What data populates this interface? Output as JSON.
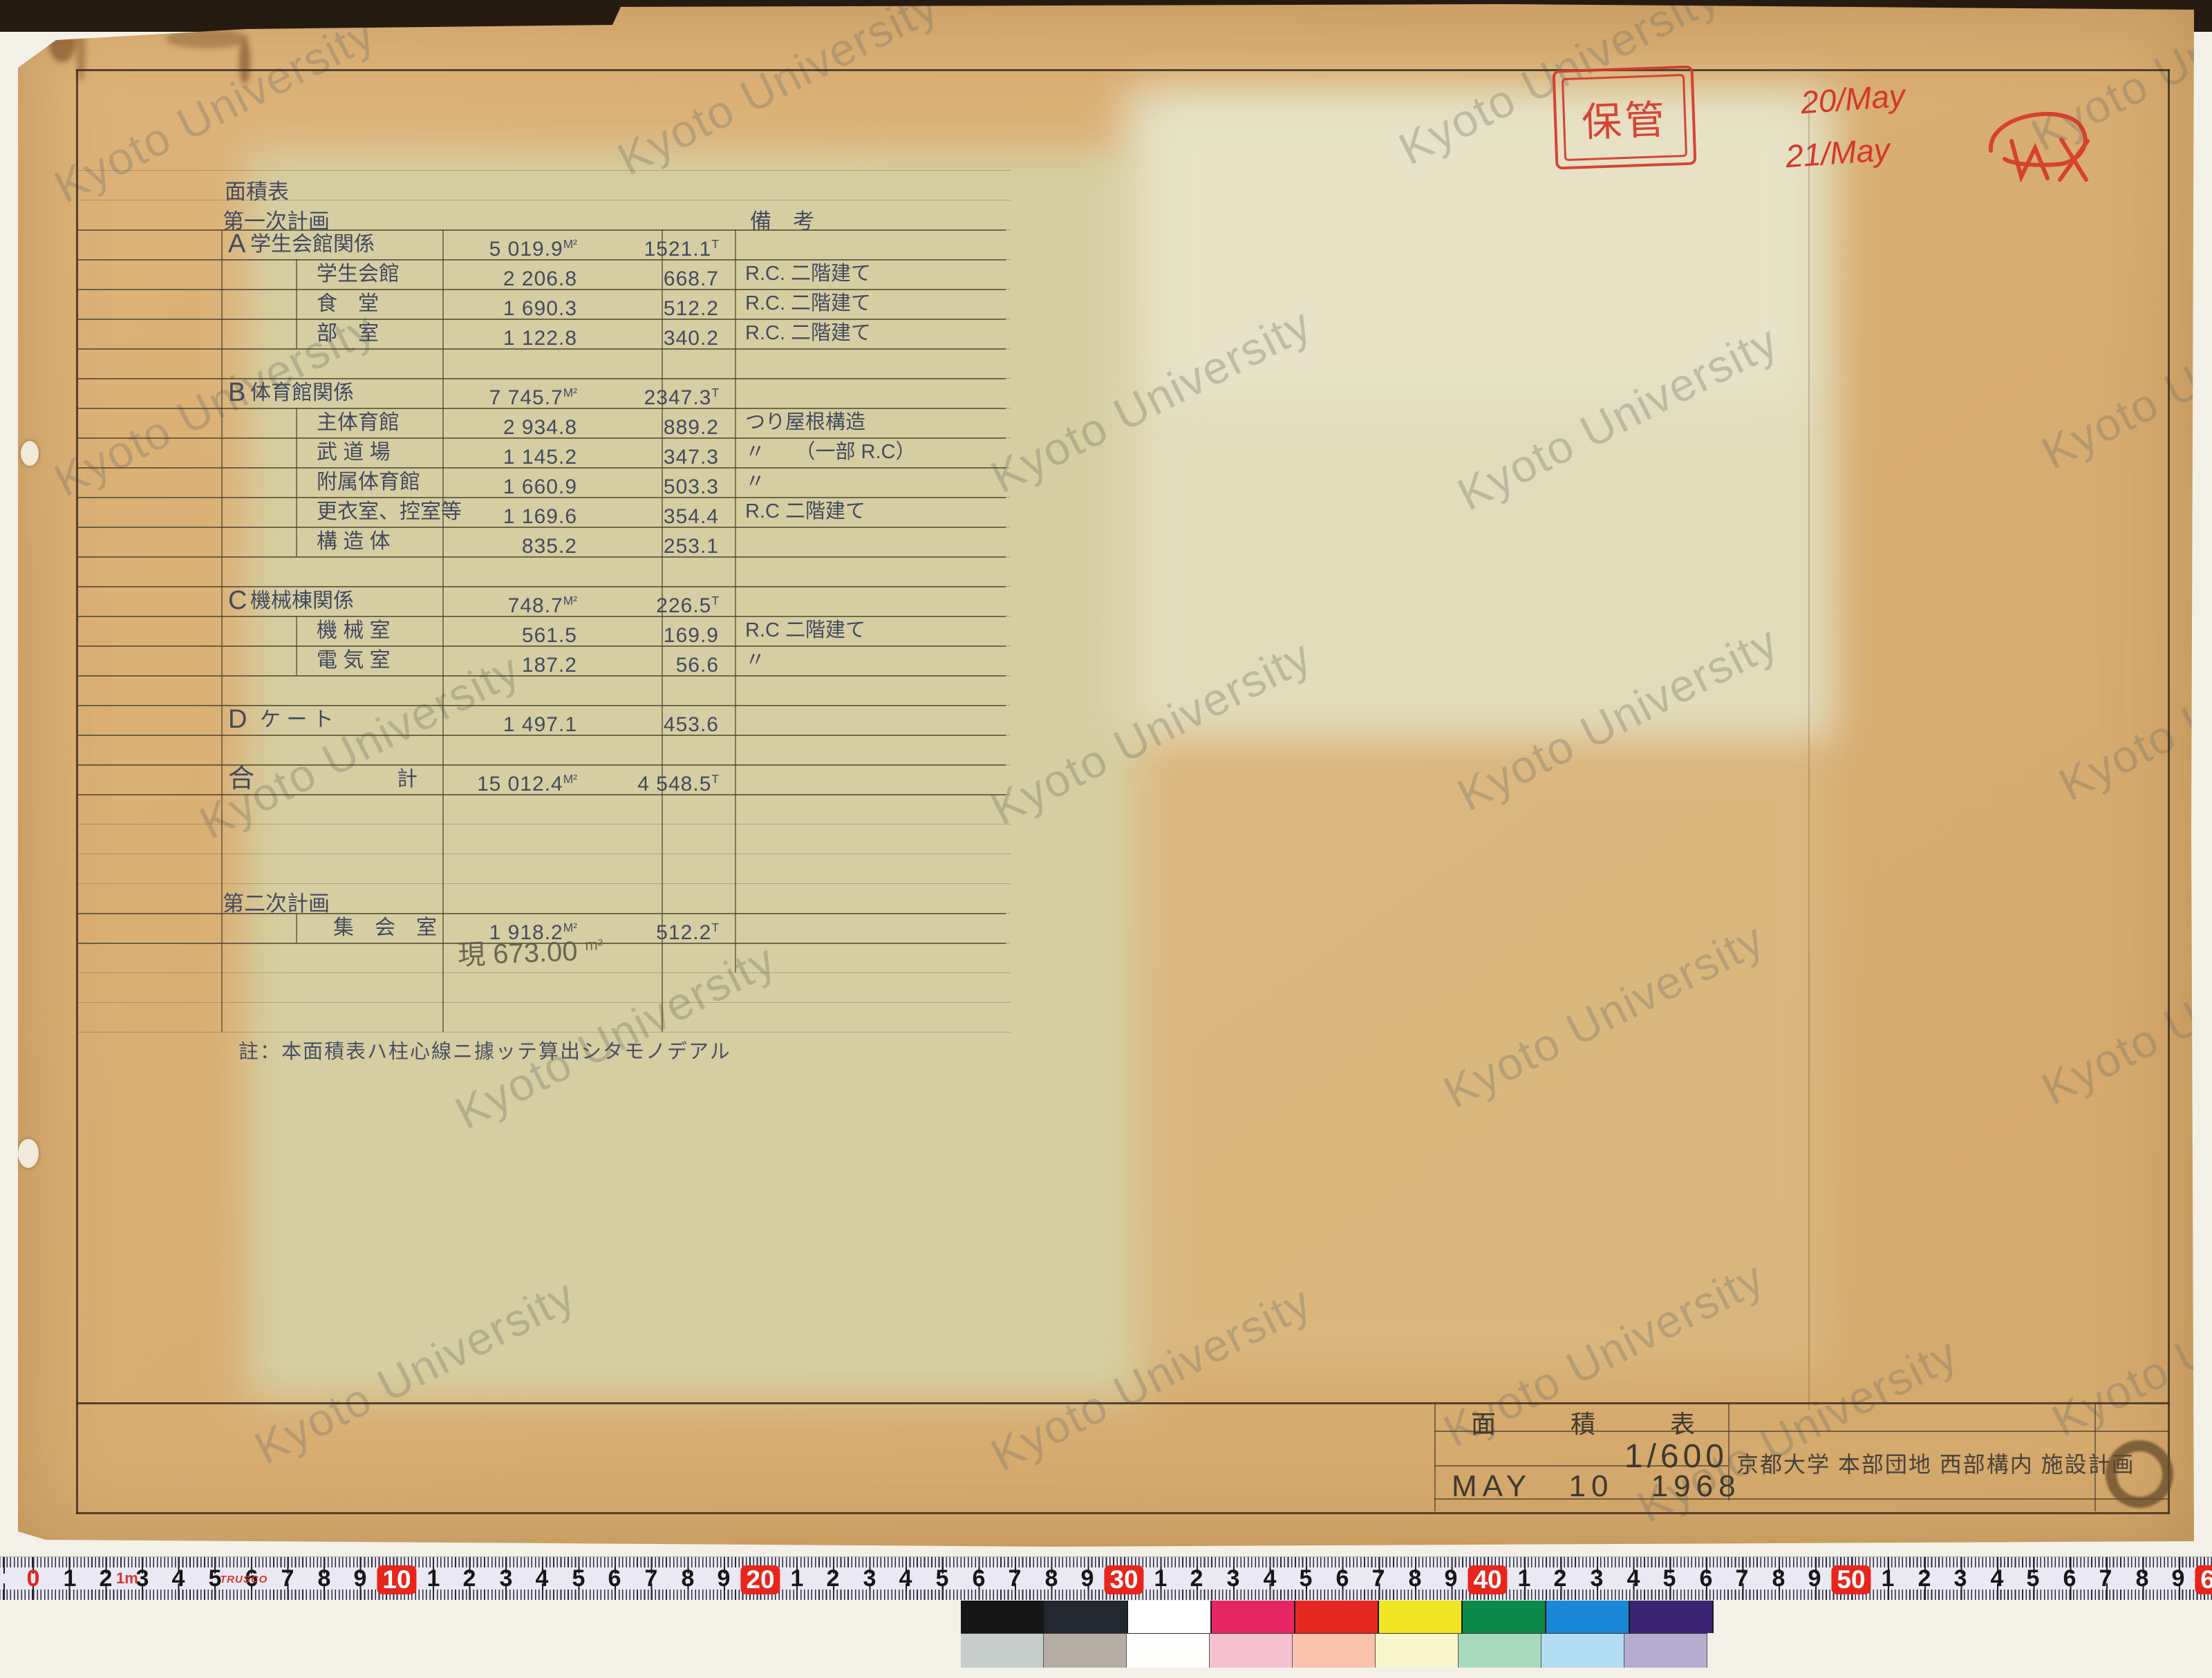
{
  "doc": {
    "watermark": "Kyoto University",
    "title_label": "面積表",
    "plan1_label": "第一次計画",
    "remarks_header": "備　考",
    "plan2_label": "第二次計画",
    "note": "註：本面積表ハ柱心線ニ據ッテ算出シタモノデアル",
    "pencil_value": "現 673.00",
    "pencil_unit": "m²"
  },
  "table": {
    "rows": [
      {
        "style": "top:332px",
        "letter": "A",
        "name": "学生会館関係",
        "ns": "",
        "m2": "5 019.9",
        "m2u": "M²",
        "t": "1521.1",
        "tu": "T",
        "rem": ""
      },
      {
        "style": "top:375px",
        "letter": "",
        "name": "学生会館",
        "ns": "padding-left:96px",
        "m2": "2 206.8",
        "m2u": "",
        "t": "668.7",
        "tu": "",
        "rem": "R.C. 二階建て"
      },
      {
        "style": "top:418px",
        "letter": "",
        "name": "食　堂",
        "ns": "padding-left:96px",
        "m2": "1 690.3",
        "m2u": "",
        "t": "512.2",
        "tu": "",
        "rem": "R.C. 二階建て"
      },
      {
        "style": "top:461px",
        "letter": "",
        "name": "部　室",
        "ns": "padding-left:96px",
        "m2": "1 122.8",
        "m2u": "",
        "t": "340.2",
        "tu": "",
        "rem": "R.C. 二階建て"
      },
      {
        "style": "top:547px",
        "letter": "B",
        "name": "体育館関係",
        "ns": "",
        "m2": "7 745.7",
        "m2u": "M²",
        "t": "2347.3",
        "tu": "T",
        "rem": ""
      },
      {
        "style": "top:590px",
        "letter": "",
        "name": "主体育館",
        "ns": "padding-left:96px",
        "m2": "2 934.8",
        "m2u": "",
        "t": "889.2",
        "tu": "",
        "rem": "つり屋根構造"
      },
      {
        "style": "top:633px",
        "letter": "",
        "name": "武 道 場",
        "ns": "padding-left:96px",
        "m2": "1 145.2",
        "m2u": "",
        "t": "347.3",
        "tu": "",
        "rem": "〃　　（一部 R.C）"
      },
      {
        "style": "top:676px",
        "letter": "",
        "name": "附属体育館",
        "ns": "padding-left:96px",
        "m2": "1 660.9",
        "m2u": "",
        "t": "503.3",
        "tu": "",
        "rem": "〃"
      },
      {
        "style": "top:719px",
        "letter": "",
        "name": "更衣室、控室等",
        "ns": "padding-left:96px",
        "m2": "1 169.6",
        "m2u": "",
        "t": "354.4",
        "tu": "",
        "rem": "R.C 二階建て"
      },
      {
        "style": "top:762px",
        "letter": "",
        "name": "構 造 体",
        "ns": "padding-left:96px",
        "m2": "835.2",
        "m2u": "",
        "t": "253.1",
        "tu": "",
        "rem": ""
      },
      {
        "style": "top:848px",
        "letter": "C",
        "name": "機械棟関係",
        "ns": "",
        "m2": "748.7",
        "m2u": "M²",
        "t": "226.5",
        "tu": "T",
        "rem": ""
      },
      {
        "style": "top:891px",
        "letter": "",
        "name": "機 械 室",
        "ns": "padding-left:96px",
        "m2": "561.5",
        "m2u": "",
        "t": "169.9",
        "tu": "",
        "rem": "R.C 二階建て"
      },
      {
        "style": "top:934px",
        "letter": "",
        "name": "電 気 室",
        "ns": "padding-left:96px",
        "m2": "187.2",
        "m2u": "",
        "t": "56.6",
        "tu": "",
        "rem": "〃"
      },
      {
        "style": "top:1020px",
        "letter": "D",
        "name": "ケ ー ト",
        "ns": "padding-left:14px",
        "m2": "1 497.1",
        "m2u": "",
        "t": "453.6",
        "tu": "",
        "rem": ""
      },
      {
        "style": "top:1106px",
        "letter": "合",
        "name": "計",
        "ns": "padding-left:212px",
        "m2": "15 012.4",
        "m2u": "M²",
        "t": "4 548.5",
        "tu": "T",
        "rem": ""
      },
      {
        "style": "top:1321px",
        "letter": "",
        "name": "集　会　室",
        "ns": "padding-left:120px",
        "m2": "1 918.2",
        "m2u": "M²",
        "t": "512.2",
        "tu": "T",
        "rem": ""
      }
    ]
  },
  "red_marks": {
    "storage_stamp": "保管",
    "date1": "20/May",
    "date2": "21/May",
    "ink_color": "#d5372a"
  },
  "title_block": {
    "title": "面積表",
    "scale": "1/600",
    "date": "MAY 10 1968",
    "project": "京都大学 本部団地 西部構内 施設計画"
  },
  "ruler": {
    "m_label": "1m",
    "brand": "TRUSCO",
    "red_color": "#e8251c",
    "numbers": [
      {
        "t": "0",
        "s": "left:48px;color:#e8251c"
      },
      {
        "t": "1",
        "s": "left:101px"
      },
      {
        "t": "2",
        "s": "left:153px"
      },
      {
        "t": "3",
        "s": "left:206px"
      },
      {
        "t": "4",
        "s": "left:258px"
      },
      {
        "t": "5",
        "s": "left:311px"
      },
      {
        "t": "6",
        "s": "left:364px"
      },
      {
        "t": "7",
        "s": "left:416px"
      },
      {
        "t": "8",
        "s": "left:469px"
      },
      {
        "t": "9",
        "s": "left:521px"
      },
      {
        "t": "10",
        "s": "left:574px;background:#e8251c;color:#fff;padding:0 8px;border-radius:8px;font-size:37px"
      },
      {
        "t": "1",
        "s": "left:627px"
      },
      {
        "t": "2",
        "s": "left:679px"
      },
      {
        "t": "3",
        "s": "left:732px"
      },
      {
        "t": "4",
        "s": "left:784px"
      },
      {
        "t": "5",
        "s": "left:837px"
      },
      {
        "t": "6",
        "s": "left:889px"
      },
      {
        "t": "7",
        "s": "left:942px"
      },
      {
        "t": "8",
        "s": "left:995px"
      },
      {
        "t": "9",
        "s": "left:1047px"
      },
      {
        "t": "20",
        "s": "left:1100px;background:#e8251c;color:#fff;padding:0 8px;border-radius:8px;font-size:37px"
      },
      {
        "t": "1",
        "s": "left:1153px"
      },
      {
        "t": "2",
        "s": "left:1205px"
      },
      {
        "t": "3",
        "s": "left:1258px"
      },
      {
        "t": "4",
        "s": "left:1310px"
      },
      {
        "t": "5",
        "s": "left:1363px"
      },
      {
        "t": "6",
        "s": "left:1416px"
      },
      {
        "t": "7",
        "s": "left:1468px"
      },
      {
        "t": "8",
        "s": "left:1521px"
      },
      {
        "t": "9",
        "s": "left:1573px"
      },
      {
        "t": "30",
        "s": "left:1626px;background:#e8251c;color:#fff;padding:0 8px;border-radius:8px;font-size:37px"
      },
      {
        "t": "1",
        "s": "left:1679px"
      },
      {
        "t": "2",
        "s": "left:1731px"
      },
      {
        "t": "3",
        "s": "left:1784px"
      },
      {
        "t": "4",
        "s": "left:1837px"
      },
      {
        "t": "5",
        "s": "left:1889px"
      },
      {
        "t": "6",
        "s": "left:1942px"
      },
      {
        "t": "7",
        "s": "left:1994px"
      },
      {
        "t": "8",
        "s": "left:2047px"
      },
      {
        "t": "9",
        "s": "left:2099px"
      },
      {
        "t": "40",
        "s": "left:2152px;background:#e8251c;color:#fff;padding:0 8px;border-radius:8px;font-size:37px"
      },
      {
        "t": "1",
        "s": "left:2205px"
      },
      {
        "t": "2",
        "s": "left:2257px"
      },
      {
        "t": "3",
        "s": "left:2310px"
      },
      {
        "t": "4",
        "s": "left:2363px"
      },
      {
        "t": "5",
        "s": "left:2415px"
      },
      {
        "t": "6",
        "s": "left:2468px"
      },
      {
        "t": "7",
        "s": "left:2520px"
      },
      {
        "t": "8",
        "s": "left:2573px"
      },
      {
        "t": "9",
        "s": "left:2625px"
      },
      {
        "t": "50",
        "s": "left:2678px;background:#e8251c;color:#fff;padding:0 8px;border-radius:8px;font-size:37px"
      },
      {
        "t": "1",
        "s": "left:2731px"
      },
      {
        "t": "2",
        "s": "left:2784px"
      },
      {
        "t": "3",
        "s": "left:2836px"
      },
      {
        "t": "4",
        "s": "left:2889px"
      },
      {
        "t": "5",
        "s": "left:2941px"
      },
      {
        "t": "6",
        "s": "left:2994px"
      },
      {
        "t": "7",
        "s": "left:3046px"
      },
      {
        "t": "8",
        "s": "left:3099px"
      },
      {
        "t": "9",
        "s": "left:3151px"
      },
      {
        "t": "60",
        "s": "left:3204px;background:#e8251c;color:#fff;padding:0 8px;border-radius:8px;font-size:37px"
      }
    ]
  },
  "colorbar": {
    "top": [
      "background:#161616",
      "background:#232830",
      "background:#ffffff",
      "background:#e72563",
      "background:#e52721",
      "background:#f1e623",
      "background:#0b8a49",
      "background:#1a87d9",
      "background:#3b2472"
    ],
    "bottom": [
      "background:#c6cdca",
      "background:#b5ada3",
      "background:#fdfdfb",
      "background:#f5c1d0",
      "background:#f8c2ad",
      "background:#f9f6cd",
      "background:#a9d9bd",
      "background:#b2ddf3",
      "background:#b6accf"
    ]
  },
  "watermarks": [
    "left:30px;top:115px",
    "left:845px;top:75px",
    "left:1975px;top:60px",
    "left:2890px;top:40px",
    "left:30px;top:540px",
    "left:1385px;top:535px",
    "left:2060px;top:560px",
    "left:2905px;top:500px",
    "left:240px;top:1035px",
    "left:1385px;top:1015px",
    "left:2060px;top:995px",
    "left:2930px;top:980px",
    "left:610px;top:1455px",
    "left:2040px;top:1425px",
    "left:2905px;top:1420px",
    "left:320px;top:1940px",
    "left:1385px;top:1950px",
    "left:2040px;top:1915px",
    "left:2920px;top:1900px",
    "left:2320px;top:2025px",
    "left:2860px;top:2265px"
  ]
}
